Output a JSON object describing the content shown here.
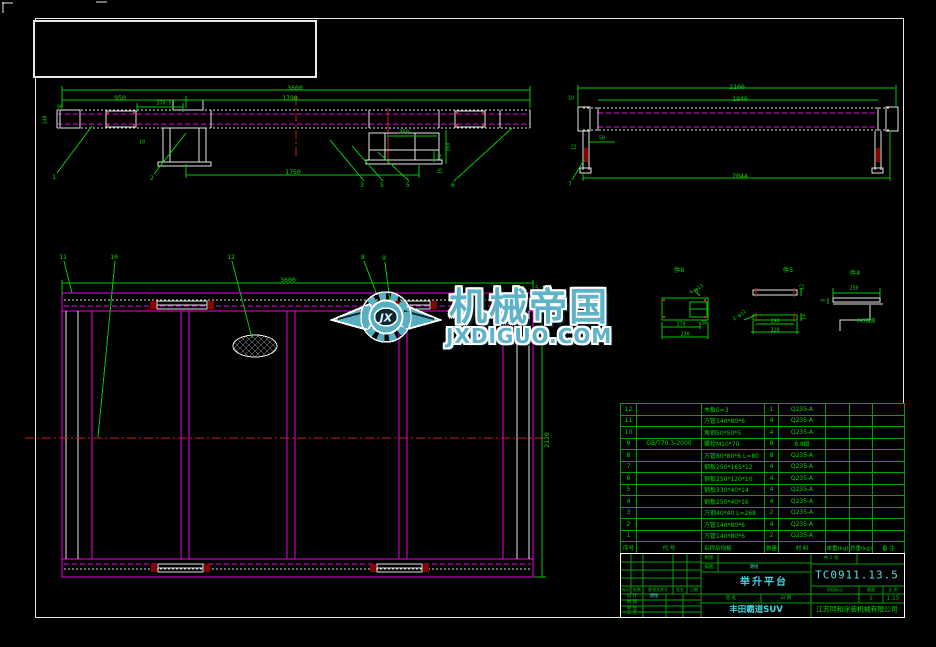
{
  "watermark": {
    "brand": "机械帝国",
    "domain": "JXDIGUO.COM",
    "logo_text": "JX"
  },
  "annotations": [
    {
      "t": "3600",
      "x": 295,
      "y": 88
    },
    {
      "t": "950",
      "x": 120,
      "y": 98
    },
    {
      "t": "1790",
      "x": 290,
      "y": 98
    },
    {
      "t": "370.5",
      "x": 164,
      "y": 104,
      "s": 5
    },
    {
      "t": "90",
      "x": 60,
      "y": 108,
      "s": 5
    },
    {
      "t": "140",
      "x": 46,
      "y": 120,
      "s": 5,
      "r": -90
    },
    {
      "t": "10",
      "x": 142,
      "y": 143,
      "s": 5
    },
    {
      "t": "1750",
      "x": 293,
      "y": 172
    },
    {
      "t": "350",
      "x": 404,
      "y": 133,
      "s": 5.5
    },
    {
      "t": "368",
      "x": 449,
      "y": 147,
      "s": 5,
      "r": -90
    },
    {
      "t": "74",
      "x": 441,
      "y": 157,
      "s": 5,
      "r": -90
    },
    {
      "t": "16",
      "x": 441,
      "y": 171,
      "s": 5,
      "r": -90
    },
    {
      "t": "1",
      "x": 54,
      "y": 177,
      "n": "callout"
    },
    {
      "t": "2",
      "x": 152,
      "y": 178,
      "n": "callout"
    },
    {
      "t": "3",
      "x": 362,
      "y": 185,
      "n": "callout"
    },
    {
      "t": "5",
      "x": 382,
      "y": 185,
      "n": "callout"
    },
    {
      "t": "5",
      "x": 408,
      "y": 185,
      "n": "callout"
    },
    {
      "t": "6",
      "x": 453,
      "y": 185,
      "n": "callout"
    },
    {
      "t": "2100",
      "x": 737,
      "y": 87
    },
    {
      "t": "1940",
      "x": 740,
      "y": 99
    },
    {
      "t": "10",
      "x": 571,
      "y": 99,
      "s": 5
    },
    {
      "t": "50",
      "x": 602,
      "y": 139,
      "s": 5
    },
    {
      "t": "12",
      "x": 575,
      "y": 147,
      "s": 5,
      "r": -90
    },
    {
      "t": "2044",
      "x": 740,
      "y": 176
    },
    {
      "t": "7",
      "x": 570,
      "y": 184,
      "n": "callout"
    },
    {
      "t": "3600",
      "x": 288,
      "y": 280
    },
    {
      "t": "2120",
      "x": 547,
      "y": 440,
      "r": -90
    },
    {
      "t": "11",
      "x": 63,
      "y": 257,
      "n": "callout"
    },
    {
      "t": "10",
      "x": 114,
      "y": 257,
      "n": "callout"
    },
    {
      "t": "12",
      "x": 231,
      "y": 257,
      "n": "callout"
    },
    {
      "t": "8",
      "x": 363,
      "y": 257,
      "n": "callout"
    },
    {
      "t": "9",
      "x": 384,
      "y": 258,
      "n": "callout"
    },
    {
      "t": "5",
      "x": 537,
      "y": 288,
      "n": "callout"
    },
    {
      "t": "件8",
      "x": 679,
      "y": 270,
      "n": "detail-label"
    },
    {
      "t": "件5",
      "x": 788,
      "y": 270,
      "n": "detail-label"
    },
    {
      "t": "件4",
      "x": 855,
      "y": 273,
      "n": "detail-label"
    },
    {
      "t": "170",
      "x": 681,
      "y": 325,
      "s": 5
    },
    {
      "t": "230",
      "x": 685,
      "y": 335,
      "s": 5
    },
    {
      "t": "30",
      "x": 704,
      "y": 324,
      "s": 5
    },
    {
      "t": "4-φ11",
      "x": 697,
      "y": 290,
      "s": 5,
      "r": -30
    },
    {
      "t": "290",
      "x": 775,
      "y": 322,
      "s": 5
    },
    {
      "t": "320",
      "x": 775,
      "y": 331,
      "s": 5
    },
    {
      "t": "2-φ11",
      "x": 740,
      "y": 316,
      "s": 5,
      "r": -35
    },
    {
      "t": "12",
      "x": 803,
      "y": 287,
      "s": 5,
      "r": -90
    },
    {
      "t": "14",
      "x": 805,
      "y": 317,
      "s": 5,
      "r": -90
    },
    {
      "t": "250",
      "x": 854,
      "y": 289,
      "s": 5
    },
    {
      "t": "6",
      "x": 824,
      "y": 300,
      "s": 5,
      "r": -90
    },
    {
      "t": "C45调质",
      "x": 866,
      "y": 322,
      "s": 5
    }
  ],
  "bom": {
    "headers": [
      "序号",
      "代  号",
      "名称及规格",
      "数量",
      "材 料",
      "单重(kg)",
      "总重(kg)",
      "备 注"
    ],
    "rows": [
      {
        "no": "12",
        "code": "",
        "spec": "木板δ=3",
        "qty": "1",
        "material": "Q235-A",
        "unit_weight": "",
        "total_weight": "",
        "remark": ""
      },
      {
        "no": "11",
        "code": "",
        "spec": "方管140*80*6",
        "qty": "4",
        "material": "Q235-A",
        "unit_weight": "",
        "total_weight": "",
        "remark": ""
      },
      {
        "no": "10",
        "code": "",
        "spec": "角钢50*50*5",
        "qty": "4",
        "material": "Q235-A",
        "unit_weight": "",
        "total_weight": "",
        "remark": ""
      },
      {
        "no": "9",
        "code": "GB/T70.3-2000",
        "spec": "螺栓M10*70",
        "qty": "8",
        "material": "8.8级",
        "unit_weight": "",
        "total_weight": "",
        "remark": ""
      },
      {
        "no": "8",
        "code": "",
        "spec": "方管80*80*6 L=80",
        "qty": "8",
        "material": "Q235-A",
        "unit_weight": "",
        "total_weight": "",
        "remark": ""
      },
      {
        "no": "7",
        "code": "",
        "spec": "钢板250*165*12",
        "qty": "4",
        "material": "Q235-A",
        "unit_weight": "",
        "total_weight": "",
        "remark": ""
      },
      {
        "no": "6",
        "code": "",
        "spec": "钢板250*120*10",
        "qty": "4",
        "material": "Q235-A",
        "unit_weight": "",
        "total_weight": "",
        "remark": ""
      },
      {
        "no": "5",
        "code": "",
        "spec": "钢板330*40*14",
        "qty": "4",
        "material": "Q235-A",
        "unit_weight": "",
        "total_weight": "",
        "remark": ""
      },
      {
        "no": "4",
        "code": "",
        "spec": "钢板250*40*16",
        "qty": "4",
        "material": "Q235-A",
        "unit_weight": "",
        "total_weight": "",
        "remark": ""
      },
      {
        "no": "3",
        "code": "",
        "spec": "方钢40*40 L=268",
        "qty": "2",
        "material": "Q235-A",
        "unit_weight": "",
        "total_weight": "",
        "remark": ""
      },
      {
        "no": "2",
        "code": "",
        "spec": "方管140*80*6",
        "qty": "4",
        "material": "Q235-A",
        "unit_weight": "",
        "total_weight": "",
        "remark": ""
      },
      {
        "no": "1",
        "code": "",
        "spec": "方管140*80*6",
        "qty": "2",
        "material": "Q235-A",
        "unit_weight": "",
        "total_weight": "",
        "remark": ""
      }
    ]
  },
  "title_block": {
    "drawing_no": "TC0911.13.5",
    "part_title": "举升平台",
    "vehicle": "丰田霸道SUV",
    "company": "江苏同和涂装机械有限公司",
    "scale_value": "1:15",
    "weight_value": "1",
    "labels": {
      "mark": "标记",
      "count": "处数",
      "change_doc": "更改文件号",
      "signature": "签名",
      "date": "日期",
      "design": "设 计",
      "draft": "制 图",
      "review": "审 核",
      "process": "工 艺",
      "plot": "制图",
      "trace": "描图",
      "drafter": "测绘",
      "sign2": "签 名",
      "date2": "日 期",
      "stage": "阶段标记",
      "weight": "重量",
      "scale": "比 例",
      "sheets": "共 1 张"
    }
  },
  "colors": {
    "dimension_green": "#00c800",
    "outline_magenta": "#ee00ee",
    "outline_white": "#e6e6e6",
    "centerline_red": "#c42020",
    "text_cyan": "#49d2dc",
    "watermark_teal": "#5fb3c8",
    "background": "#000000"
  }
}
